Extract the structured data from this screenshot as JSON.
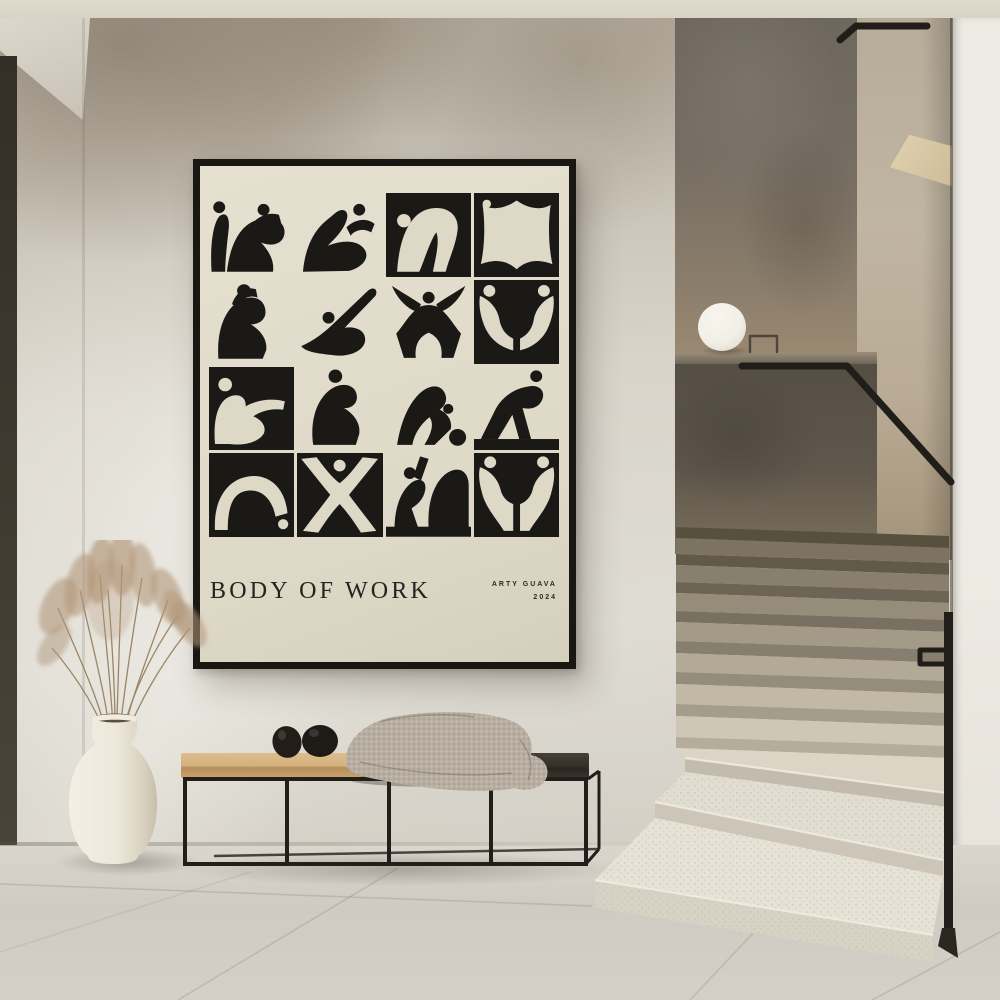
{
  "poster": {
    "title": "BODY OF WORK",
    "artist": "ARTY GUAVA",
    "year": "2024",
    "tiles": [
      "two seated figures",
      "reclining figure with raised leg",
      "figure bending forward",
      "figure stretched into a square",
      "figure hugging knees",
      "diving figure",
      "squatting figure with raised arms",
      "two figures seated face to face",
      "reclining figure pointing",
      "crouching figure",
      "figure reaching for a ball",
      "striding figure on block",
      "backbend arch figure",
      "star jump figure",
      "seated figure pointing upward",
      "two seated figures on stools"
    ]
  },
  "colors": {
    "ink": "#1b1916",
    "posterCream": "#ded8c7",
    "frame": "#191712",
    "ceiling": "#d9d3c7",
    "wallTop": "#b3a998",
    "wall": "#d8d4ca",
    "leftBand": "#3b372e",
    "landing": "#756d62",
    "sideWall": "#c0b5a2",
    "guard": "#5f574b",
    "rightWall": "#edeae3",
    "rail": "#211e1a",
    "stepDark": "#6a6254",
    "stepLight": "#e4dfd3",
    "floor": "#cfcbc2",
    "wood": "#d4b07c",
    "slab": "#352f29",
    "metal": "#221f1b",
    "cushion": "#b7aea1",
    "vase": "#ede7da",
    "pampas": "#b2977a",
    "lamp": "#f2efe7"
  }
}
